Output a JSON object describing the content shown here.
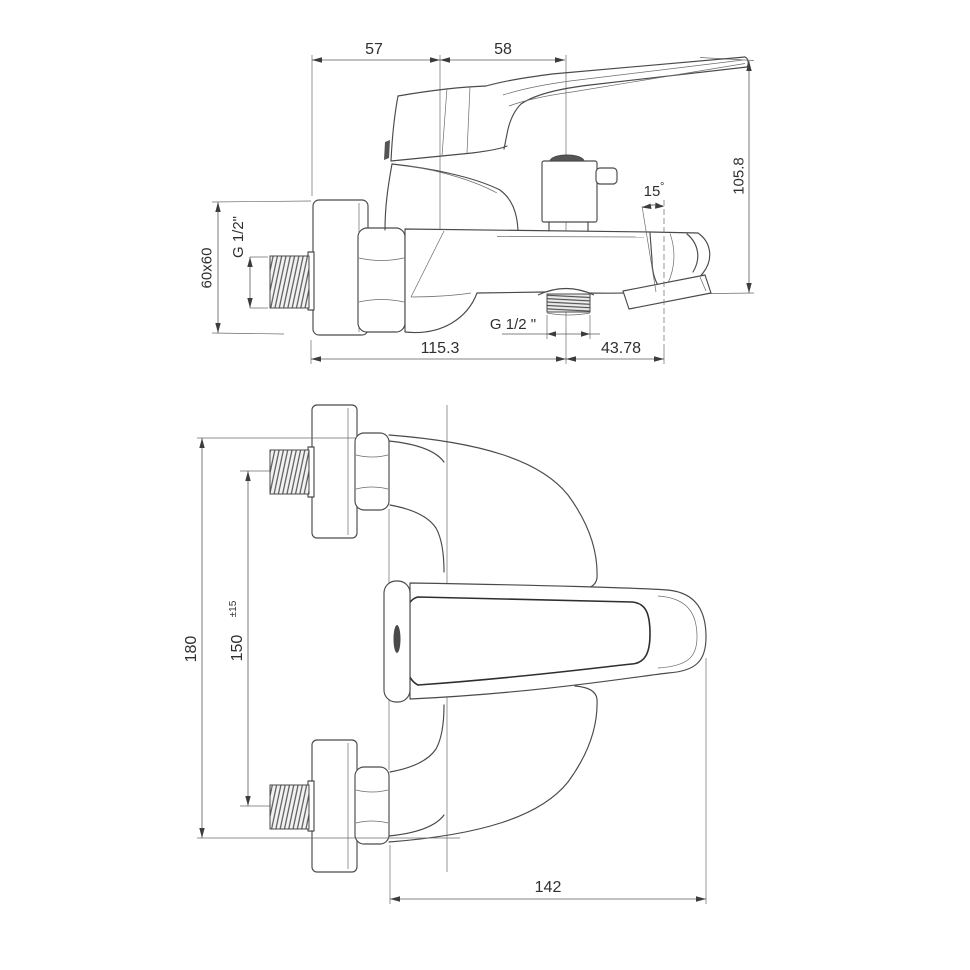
{
  "drawing": {
    "title": "wall-mounted bath mixer tap technical drawing, two orthographic views",
    "colors": {
      "line": "#4a4a4a",
      "text": "#2f2f2f",
      "background": "#ffffff"
    },
    "side_view": {
      "dims": {
        "top_left": "57",
        "top_right": "58",
        "height": "105.8",
        "plate": "60x60",
        "inlet_thread": "G 1/2\"",
        "outlet_thread": "G 1/2 \"",
        "angle": "15",
        "angle_symbol": "°",
        "wall_to_outlet": "115.3",
        "outlet_to_tip": "43.78"
      }
    },
    "plan_view": {
      "dims": {
        "overall": "180",
        "spacing": "150",
        "tolerance": "±15",
        "projection": "142"
      }
    }
  }
}
